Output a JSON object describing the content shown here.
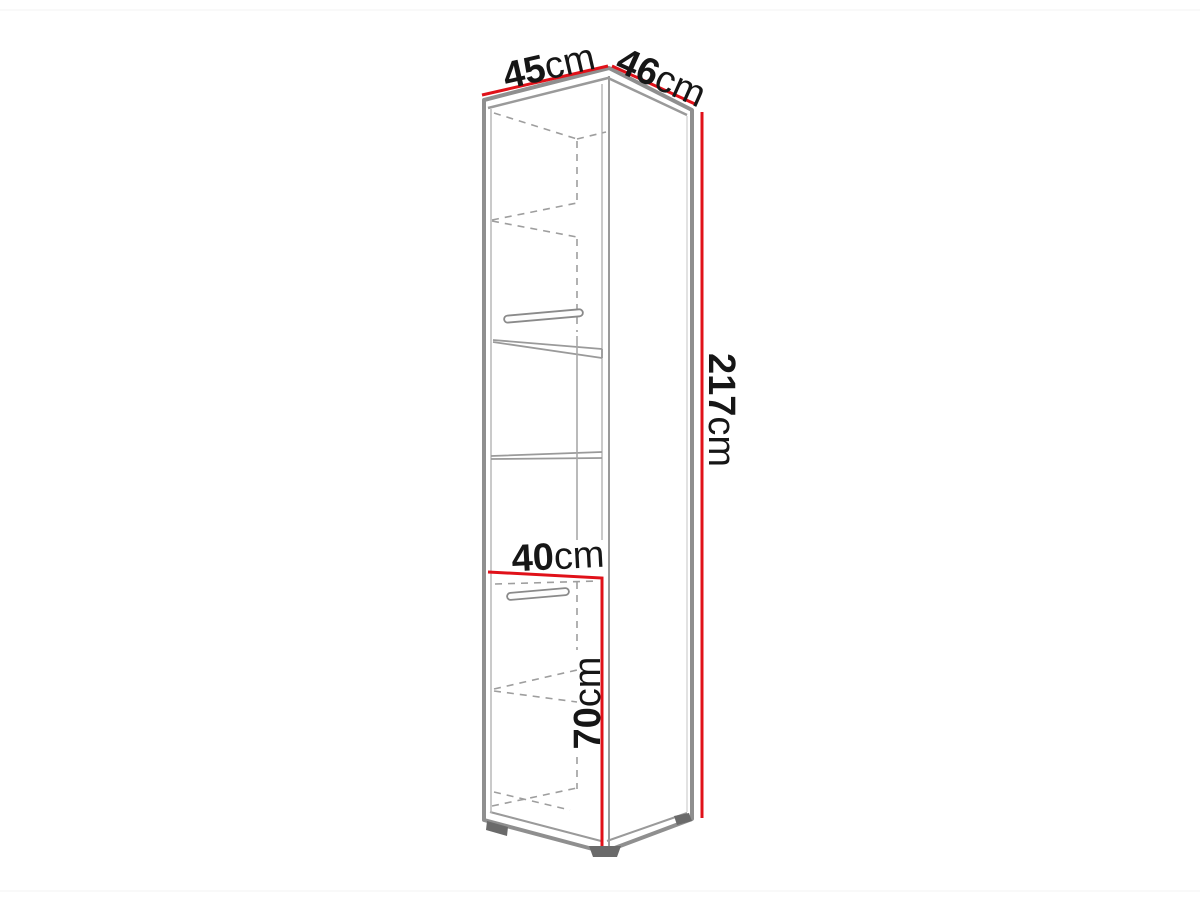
{
  "diagram": {
    "type": "furniture-dimension-drawing",
    "subject": "tall narrow cabinet with shelves, two handles and feet, shown in perspective line art"
  },
  "colors": {
    "dimension_red": "#e01119",
    "edge_gray": "#8f8f8f",
    "inner_gray": "#9a9a9a",
    "dash_gray": "#9e9e9e",
    "light_gray": "#b8b8b8",
    "foot_gray": "#6a6a6a",
    "page_edge": "#f3f3f3"
  },
  "dimensions": {
    "top_width": {
      "value": "45",
      "unit": "cm"
    },
    "top_depth": {
      "value": "46",
      "unit": "cm"
    },
    "height": {
      "value": "217",
      "unit": "cm"
    },
    "niche_width": {
      "value": "40",
      "unit": "cm"
    },
    "lower_section_height": {
      "value": "70",
      "unit": "cm"
    }
  }
}
